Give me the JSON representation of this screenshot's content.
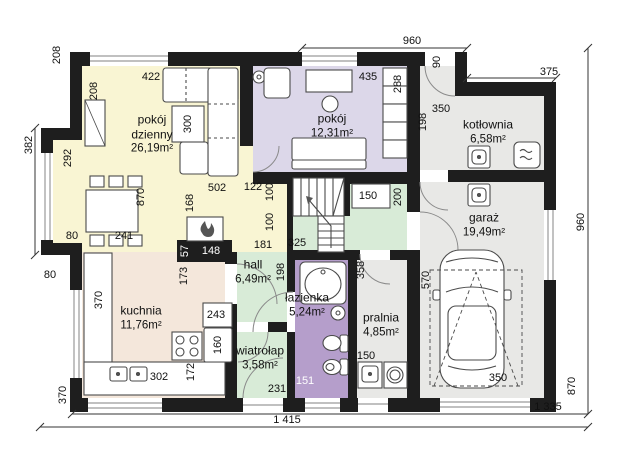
{
  "colors": {
    "wall": "#1e1e1e",
    "living": "#f9f5d3",
    "bedroom": "#dcd7e9",
    "bathroom": "#b59ecb",
    "green": "#d8ebd7",
    "gray": "#e8e8e6",
    "kitchen": "#f4e7db",
    "line": "#4a4a4a",
    "window": "#9a9a9a",
    "dim": "#333333"
  },
  "rooms": {
    "living": {
      "name": "pokój dzienny",
      "area": "26,19m²"
    },
    "bedroom": {
      "name": "pokój",
      "area": "12,31m²"
    },
    "boiler": {
      "name": "kotłownia",
      "area": "6,58m²"
    },
    "garage": {
      "name": "garaż",
      "area": "19,49m²"
    },
    "kitchen": {
      "name": "kuchnia",
      "area": "11,76m²"
    },
    "hall": {
      "name": "hall",
      "area": "6,49m²"
    },
    "bathroom": {
      "name": "łazienka",
      "area": "5,24m²"
    },
    "vestibule": {
      "name": "wiatrołap",
      "area": "3,58m²"
    },
    "laundry": {
      "name": "pralnia",
      "area": "4,85m²"
    }
  },
  "dims": {
    "top_960": "960",
    "door_90": "90",
    "top_375": "375",
    "left_208_outer": "208",
    "left_208_inner": "208",
    "left_382": "382",
    "left_292": "292",
    "sofa_422": "422",
    "desk_435": "435",
    "wardrobe_288": "288",
    "boiler_350": "350",
    "boiler_198": "198",
    "table_300": "300",
    "living_870": "870",
    "fireplace_168": "168",
    "sofa_502": "502",
    "stair_122": "122",
    "stair_100_upper": "100",
    "stair_100_lower": "100",
    "cabinet_150": "150",
    "cabinet_200": "200",
    "dining_241": "241",
    "dining_80": "80",
    "bump_80": "80",
    "fireplace_57": "57",
    "fireplace_148": "148",
    "hall_181": "181",
    "stair_325": "325",
    "kitchen_173": "173",
    "kitchen_370": "370",
    "hall_198": "198",
    "counter_243": "243",
    "fridge_160": "160",
    "counter_172": "172",
    "sink_302": "302",
    "laundry_358": "358",
    "garage_570": "570",
    "laundry_150": "150",
    "vestibule_231": "231",
    "bathroom_151": "151",
    "garage_door_350": "350",
    "bottom_left_370": "370",
    "right_960": "960",
    "right_870": "870",
    "total_width": "1 415",
    "body_width": "1 335"
  }
}
